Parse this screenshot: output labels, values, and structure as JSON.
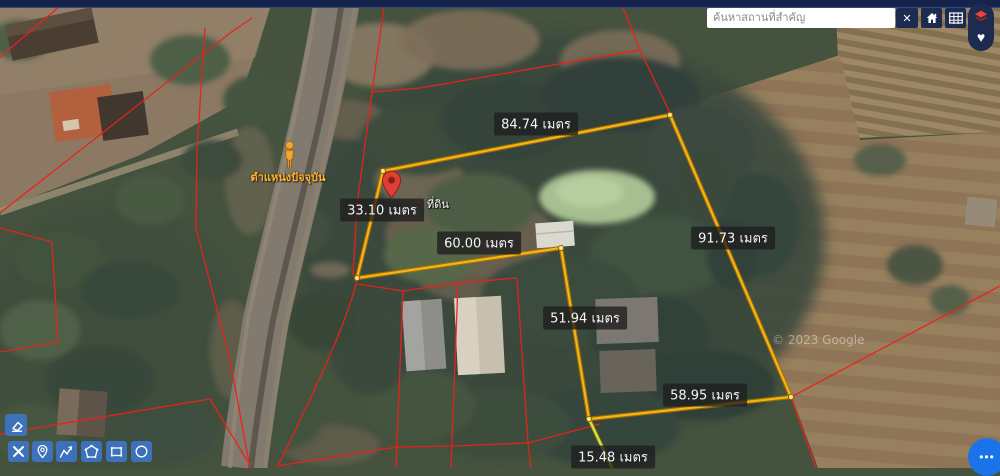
{
  "search": {
    "placeholder": "ค้นหาสถานที่สำคัญ",
    "value": ""
  },
  "controls": {
    "close_label": "✕"
  },
  "pill": {
    "heart_label": "♥"
  },
  "measurements": [
    {
      "text": "84.74 เมตร",
      "value": 84.74,
      "unit": "เมตร",
      "side": "top"
    },
    {
      "text": "91.73 เมตร",
      "value": 91.73,
      "unit": "เมตร",
      "side": "right"
    },
    {
      "text": "60.00 เมตร",
      "value": 60.0,
      "unit": "เมตร",
      "side": "inner-left"
    },
    {
      "text": "33.10 เมตร",
      "value": 33.1,
      "unit": "เมตร",
      "side": "left"
    },
    {
      "text": "51.94 เมตร",
      "value": 51.94,
      "unit": "เมตร",
      "side": "inner-right"
    },
    {
      "text": "58.95 เมตร",
      "value": 58.95,
      "unit": "เมตร",
      "side": "bottom"
    },
    {
      "text": "15.48 เมตร",
      "value": 15.48,
      "unit": "เมตร",
      "side": "spur"
    }
  ],
  "marker": {
    "label": "ที่ดิน"
  },
  "pegman": {
    "label": "ตำแหน่งปัจจุบัน"
  },
  "watermark": {
    "text": "© 2023 Google"
  },
  "fab": {
    "label": "•••"
  },
  "colors": {
    "parcel_line": "#f7b414",
    "spur_line": "#dede3a",
    "cadastral_line": "#ee2019",
    "accent_blue": "#1a73e8",
    "toolbar_blue": "#3e74c6",
    "topbar_navy": "#16234a",
    "marker_red": "#e03d35",
    "pegman_orange": "#f4a72b"
  }
}
